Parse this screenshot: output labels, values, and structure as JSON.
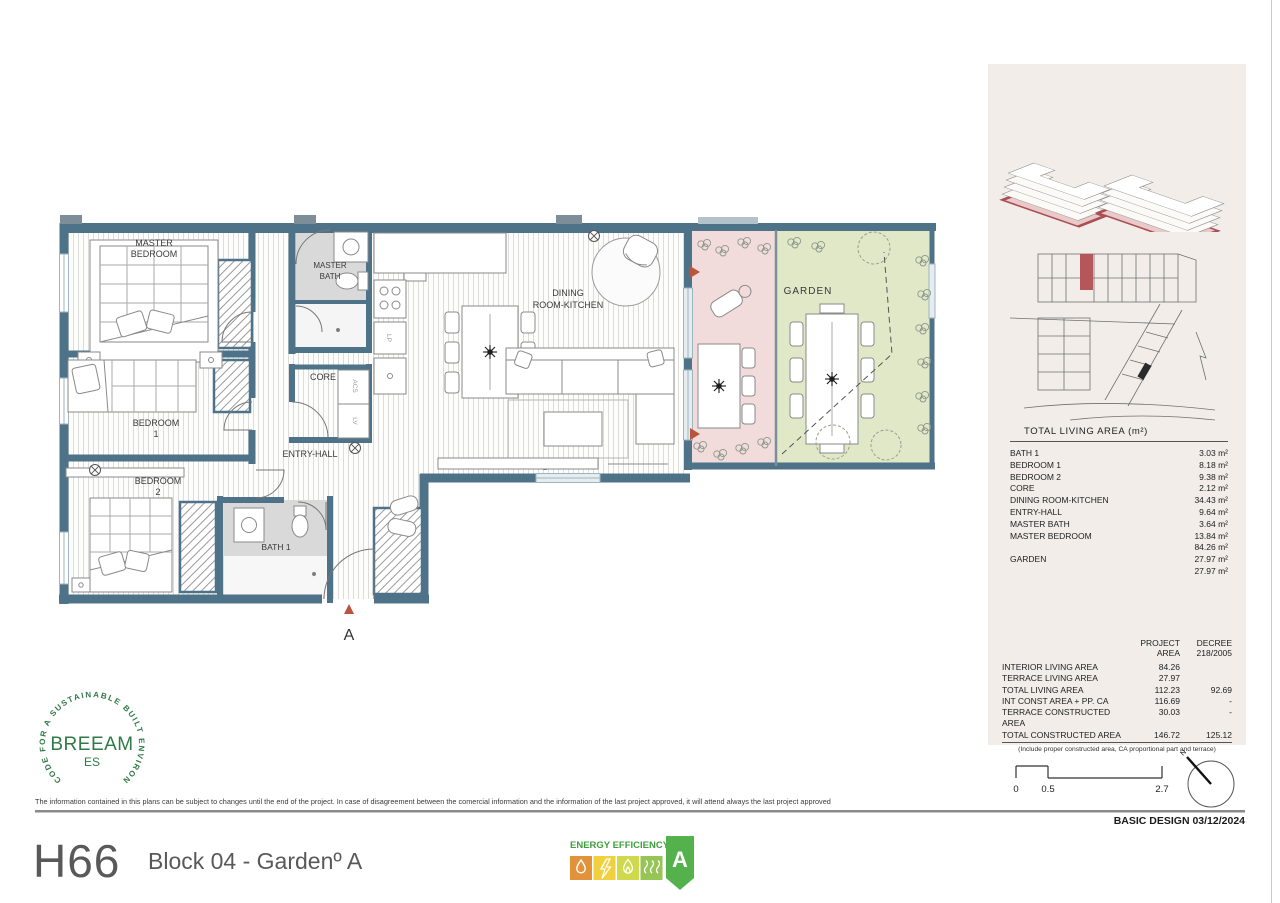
{
  "sheet": {
    "unit_code": "H66",
    "block_label": "Block 04 -  Gardenº A",
    "disclaimer": "The information contained in this plans can be subject to changes until the end of the project. In case of disagreement between the comercial information and the information of the last project approved, it will attend always the last project approved",
    "stage_label": "BASIC DESIGN 03/12/2024"
  },
  "plan": {
    "labels": {
      "master_bedroom_l1": "MASTER",
      "master_bedroom_l2": "BEDROOM",
      "master_bath_l1": "MASTER",
      "master_bath_l2": "BATH",
      "core": "CORE",
      "bedroom1_l1": "BEDROOM",
      "bedroom1_l2": "1",
      "bedroom2_l1": "BEDROOM",
      "bedroom2_l2": "2",
      "entry_hall": "ENTRY-HALL",
      "bath1": "BATH 1",
      "dining_l1": "DINING",
      "dining_l2": "ROOM-KITCHEN",
      "garden": "GARDEN",
      "closet_acs": "ACS",
      "closet_lv": "LV",
      "closet_lp": "LP",
      "section_marker": "A"
    },
    "colors": {
      "wall": "#4e7389",
      "terrace_floor": "#f2dcdb",
      "garden_floor": "#e0e8c8",
      "bath_floor": "#d9d9d9",
      "marker_red": "#b9543f"
    }
  },
  "breeam": {
    "ring_text": "CODE FOR A SUSTAINABLE BUILT ENVIRONMENT",
    "brand": "BREEAM",
    "region": "ES"
  },
  "energy_label": {
    "title": "ENERGY EFFICIENCY",
    "rating": "A"
  },
  "area_table": {
    "title": "TOTAL LIVING AREA (m²)",
    "rows": [
      {
        "label": "BATH 1",
        "value": "3.03 m²"
      },
      {
        "label": "BEDROOM 1",
        "value": "8.18 m²"
      },
      {
        "label": "BEDROOM 2",
        "value": "9.38 m²"
      },
      {
        "label": "CORE",
        "value": "2.12 m²"
      },
      {
        "label": "DINING ROOM-KITCHEN",
        "value": "34.43 m²"
      },
      {
        "label": "ENTRY-HALL",
        "value": "9.64 m²"
      },
      {
        "label": "MASTER BATH",
        "value": "3.64 m²"
      },
      {
        "label": "MASTER BEDROOM",
        "value": "13.84 m²"
      },
      {
        "label": "",
        "value": "84.26 m²"
      },
      {
        "label": "GARDEN",
        "value": "27.97 m²"
      },
      {
        "label": "",
        "value": "27.97 m²"
      }
    ]
  },
  "summary_table": {
    "header_project_l1": "PROJECT",
    "header_project_l2": "AREA",
    "header_decree_l1": "DECREE",
    "header_decree_l2": "218/2005",
    "rows": [
      {
        "label": "INTERIOR LIVING AREA",
        "project": "84.26",
        "decree": ""
      },
      {
        "label": "TERRACE LIVING AREA",
        "project": "27.97",
        "decree": ""
      },
      {
        "label": "TOTAL LIVING AREA",
        "project": "112.23",
        "decree": "92.69"
      },
      {
        "label": "INT CONST AREA + PP. CA",
        "project": "116.69",
        "decree": "-"
      },
      {
        "label": "TERRACE CONSTRUCTED AREA",
        "project": "30.03",
        "decree": "-"
      },
      {
        "label": "TOTAL CONSTRUCTED AREA",
        "project": "146.72",
        "decree": "125.12"
      }
    ],
    "footnote": "(Include proper constructed area, CA proportional part and terrace)"
  },
  "scale_bar": {
    "tick0": "0",
    "tick1": "0.5",
    "tick2": "2.7"
  },
  "north_label": "N"
}
